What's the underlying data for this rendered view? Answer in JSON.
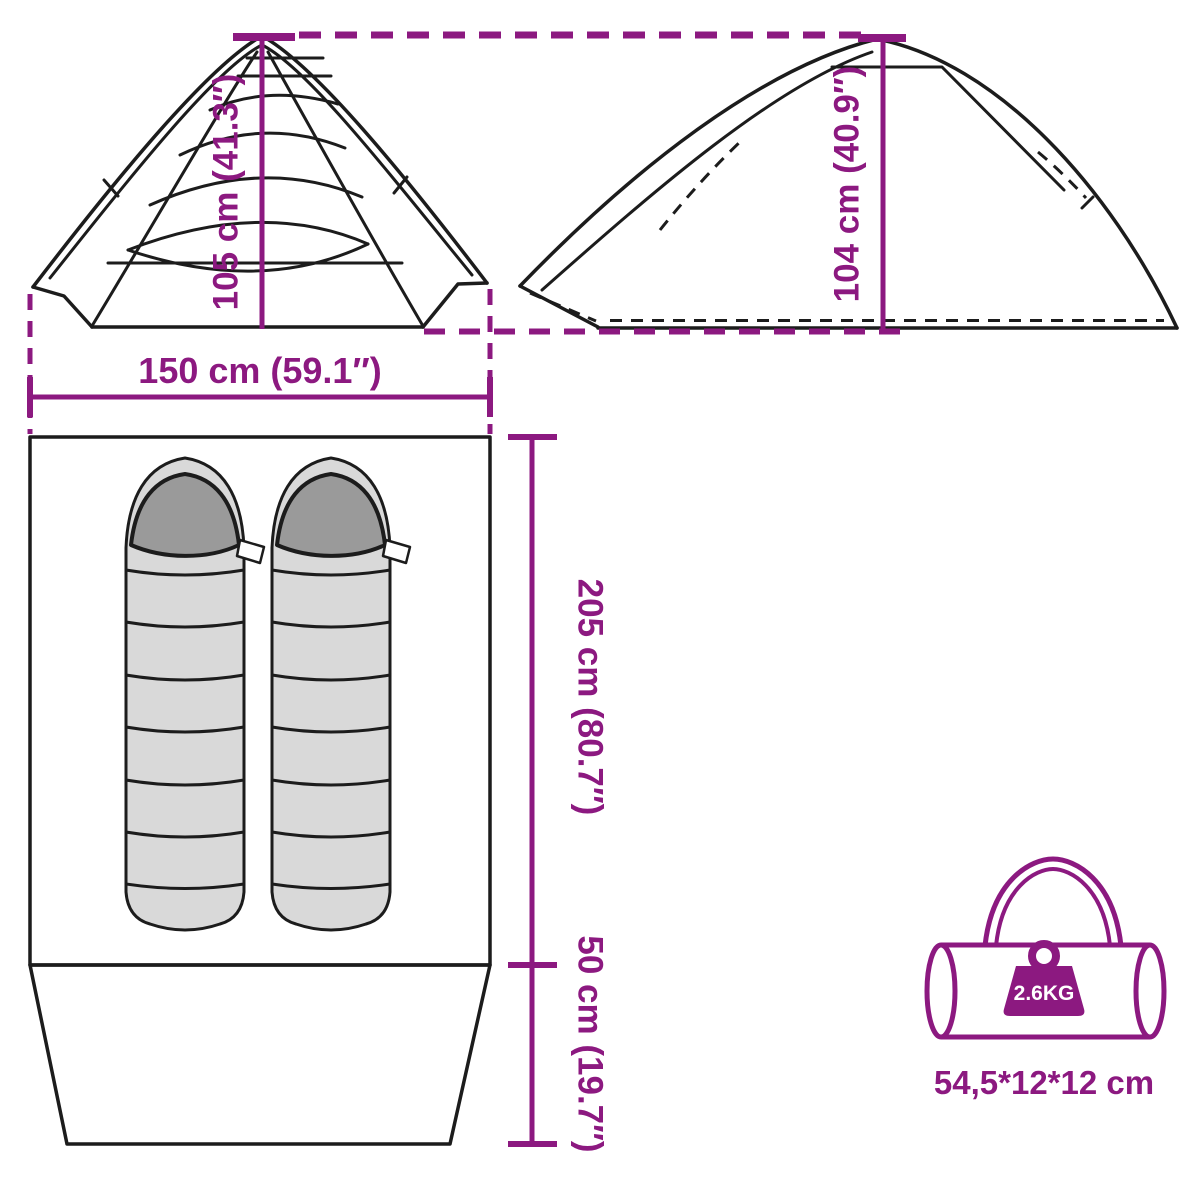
{
  "colors": {
    "accent": "#8C1980",
    "line": "#1c1c1c",
    "bag_body": "#d9d9d9",
    "bag_hood": "#9a9a9a"
  },
  "front_view": {
    "height_label": "105 cm (41.3″)",
    "width_label": "150 cm (59.1″)"
  },
  "side_view": {
    "height_label": "104 cm (40.9″)"
  },
  "floor_plan": {
    "length_label": "205 cm (80.7″)",
    "vestibule_label": "50 cm (19.7″)"
  },
  "carry_bag": {
    "weight_label": "2.6KG",
    "size_label": "54,5*12*12 cm"
  }
}
